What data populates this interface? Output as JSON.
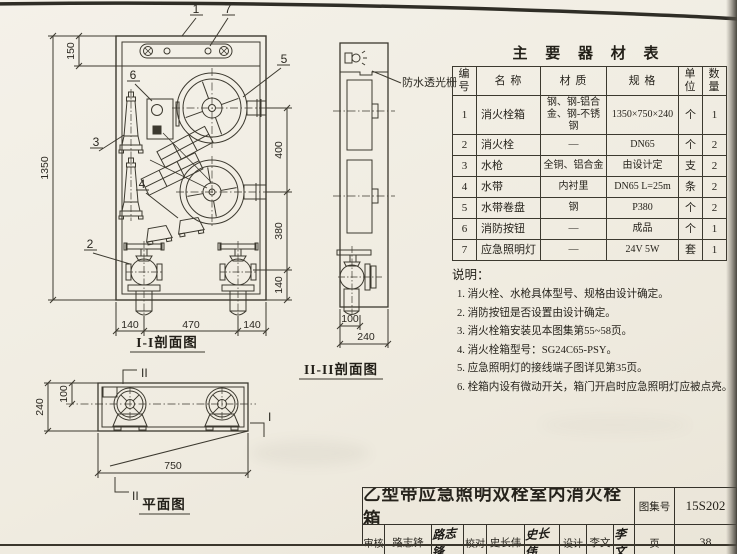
{
  "front_view": {
    "label": "I-I剖面图",
    "callouts": {
      "c1": "1",
      "c2": "2",
      "c3": "3",
      "c4": "4",
      "c5": "5",
      "c6": "6",
      "c7": "7"
    },
    "dims": {
      "left_top": "150",
      "left_total": "1350",
      "right_upper": "400",
      "right_mid": "380",
      "right_lower": "140",
      "bottom_left": "140",
      "bottom_center": "470",
      "bottom_right": "140"
    }
  },
  "side_view": {
    "label": "II-II剖面图",
    "annotation": "防水透光栅",
    "dims": {
      "inner": "100",
      "total": "240"
    }
  },
  "plan_view": {
    "label": "平面图",
    "dims": {
      "inset": "100",
      "depth": "240",
      "width": "750"
    },
    "marks": {
      "top": "II",
      "bottom": "II",
      "right": "I"
    }
  },
  "equipment_table": {
    "title": "主 要 器 材 表",
    "headers": [
      "编号",
      "名  称",
      "材  质",
      "规  格",
      "单位",
      "数量"
    ],
    "rows": [
      {
        "no": "1",
        "name": "消火栓箱",
        "material": "钢、钢-铝合金、钢-不锈钢",
        "spec": "1350×750×240",
        "unit": "个",
        "qty": "1"
      },
      {
        "no": "2",
        "name": "消火栓",
        "material": "—",
        "spec": "DN65",
        "unit": "个",
        "qty": "2"
      },
      {
        "no": "3",
        "name": "水枪",
        "material": "全铜、铝合金",
        "spec": "由设计定",
        "unit": "支",
        "qty": "2"
      },
      {
        "no": "4",
        "name": "水带",
        "material": "内衬里",
        "spec": "DN65 L=25m",
        "unit": "条",
        "qty": "2"
      },
      {
        "no": "5",
        "name": "水带卷盘",
        "material": "钢",
        "spec": "P380",
        "unit": "个",
        "qty": "2"
      },
      {
        "no": "6",
        "name": "消防按钮",
        "material": "—",
        "spec": "成品",
        "unit": "个",
        "qty": "1"
      },
      {
        "no": "7",
        "name": "应急照明灯",
        "material": "—",
        "spec": "24V 5W",
        "unit": "套",
        "qty": "1"
      }
    ]
  },
  "notes": {
    "title": "说明：",
    "items": [
      "1. 消火栓、水枪具体型号、规格由设计确定。",
      "2. 消防按钮是否设置由设计确定。",
      "3. 消火栓箱安装见本图集第55~58页。",
      "4. 消火栓箱型号：SG24C65-PSY。",
      "5. 应急照明灯的接线端子图详见第35页。",
      "6. 栓箱内设有微动开关，箱门开启时应急照明灯应被点亮。"
    ]
  },
  "title_block": {
    "drawing_title": "乙型带应急照明双栓室内消火栓箱",
    "atlas_label": "图集号",
    "atlas_number": "15S202",
    "page_label": "页",
    "page_number": "38",
    "review_label": "审核",
    "review_name": "路志锋",
    "review_signature": "路志锋",
    "check_label": "校对",
    "check_name": "史长伟",
    "check_signature": "史长伟",
    "design_label": "设计",
    "design_name": "李文",
    "design_signature": "李文"
  }
}
